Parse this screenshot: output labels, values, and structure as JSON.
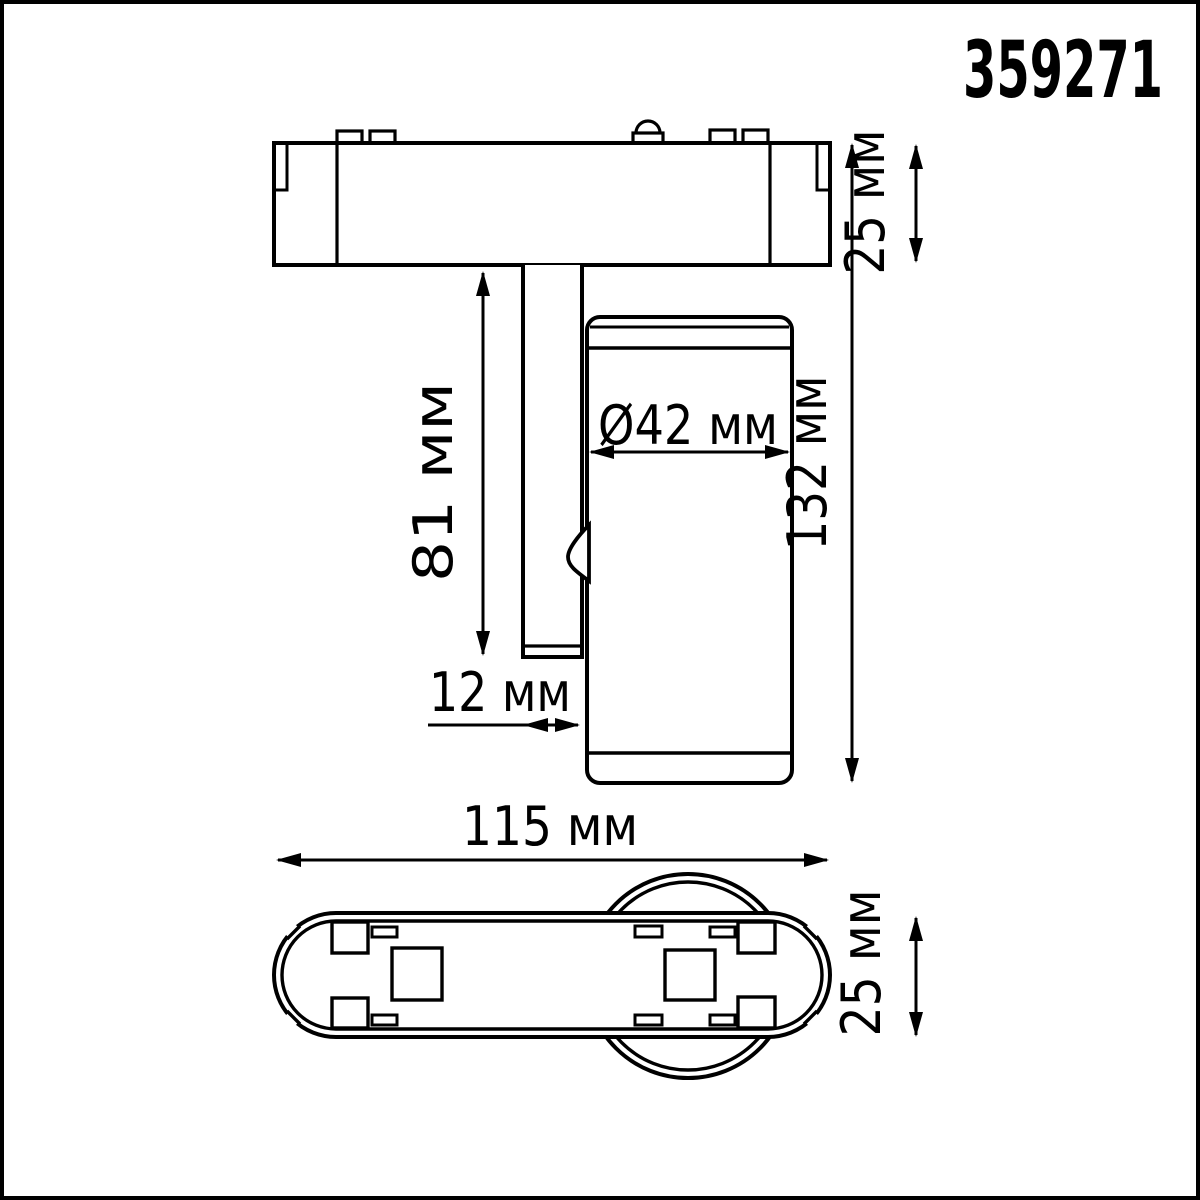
{
  "product_code": "359271",
  "units": "мм",
  "side_view": {
    "adapter_height": "25 мм",
    "stem_length": "81 мм",
    "head_diameter": "Ø42 мм",
    "total_height": "132 мм",
    "stem_offset": "12 мм"
  },
  "bottom_view": {
    "base_length": "115 мм",
    "base_width": "25 мм"
  },
  "colors": {
    "line": "#000000",
    "background": "#ffffff",
    "frame": "#333333"
  }
}
